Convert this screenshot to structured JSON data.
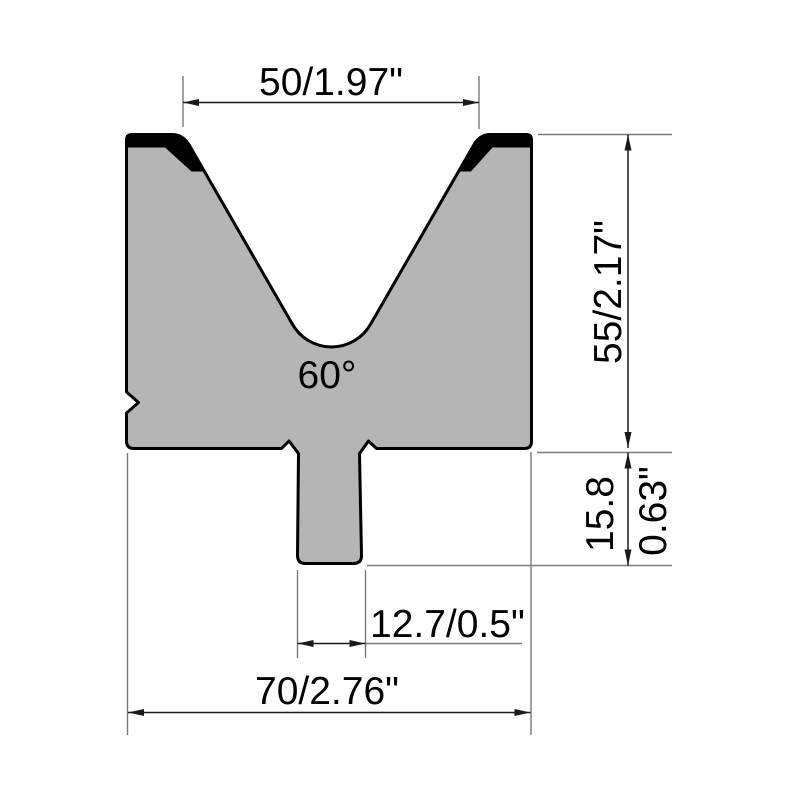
{
  "drawing": {
    "labels": {
      "v_opening_width": "50/1.97\"",
      "die_angle": "60°",
      "body_height": "55/2.17\"",
      "shank_height_mm": "15.8",
      "shank_height_in": "0.63\"",
      "shank_width": "12.7/0.5\"",
      "overall_width": "70/2.76\""
    },
    "colors": {
      "background": "#ffffff",
      "body_fill": "#b5b5b5",
      "outline": "#000000",
      "hardened_edge": "#000000",
      "dimension_line": "#1a1a1a",
      "extension_line": "#7a7a7a",
      "label_text": "#000000"
    }
  }
}
